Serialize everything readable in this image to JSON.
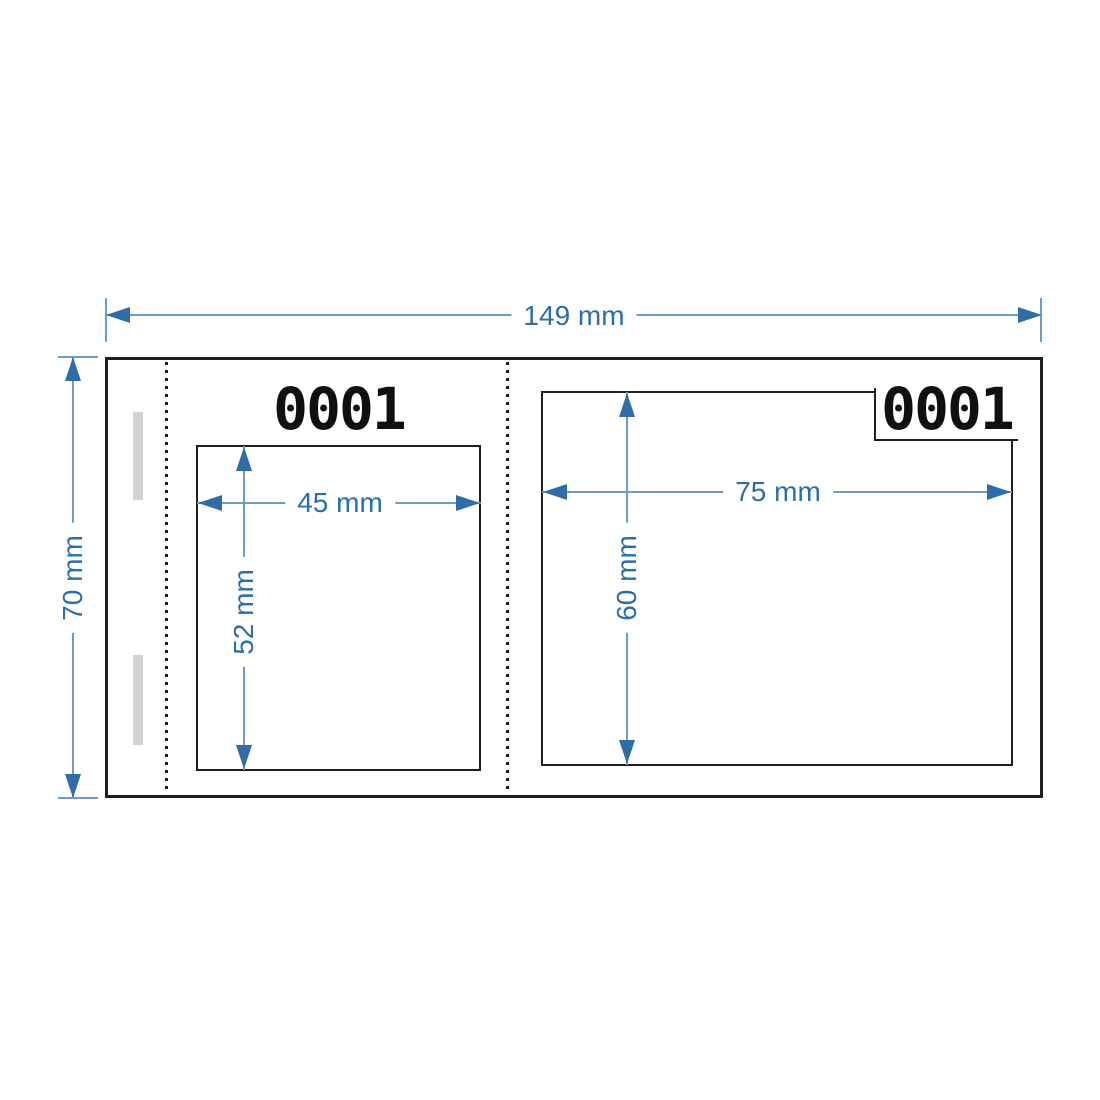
{
  "diagram": {
    "overall_width": {
      "label": "149 mm"
    },
    "overall_height": {
      "label": "70 mm"
    },
    "stub": {
      "serial_number": "0001",
      "print_area": {
        "width_label": "45 mm",
        "height_label": "52 mm"
      }
    },
    "main_ticket": {
      "serial_number": "0001",
      "print_area": {
        "width_label": "75 mm",
        "height_label": "60 mm"
      }
    },
    "colors": {
      "dimension_line": "#6b9ccd",
      "arrow": "#2e6da8",
      "dimension_text": "#2a6fad",
      "outline": "#1f1f1f",
      "glue_mark": "#d3d3d3"
    }
  }
}
